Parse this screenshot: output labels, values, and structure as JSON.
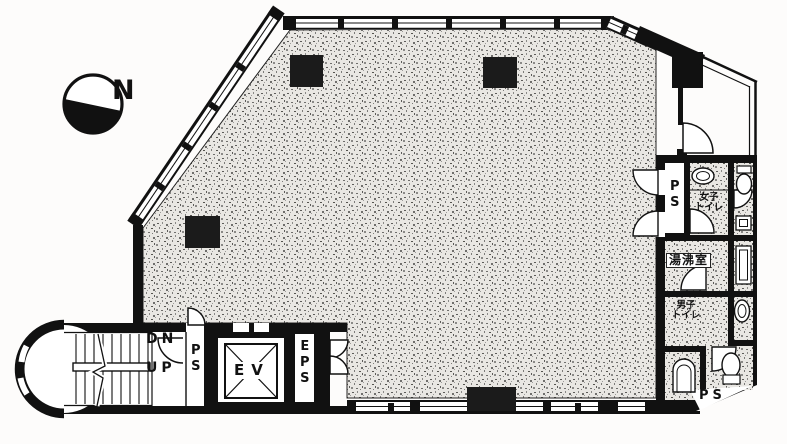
{
  "plan": {
    "compass": {
      "label": "N"
    },
    "stairwell": {
      "down_label": "DN",
      "up_label": "UP"
    },
    "shafts": {
      "stair_ps_label": "PS",
      "elevator_label": "EV",
      "eps_label": "EPS",
      "toilet_ps_top_label": "PS",
      "toilet_ps_bottom_label": "PS"
    },
    "rooms": {
      "womens_toilet_label": "女子\nトイレ",
      "kitchenette_label": "湯沸室",
      "mens_toilet_label": "男子\nトイレ"
    },
    "colors": {
      "wall": "#151515",
      "hatch_bg": "#e9e7e3",
      "hatch_dot": "#6f6e6c",
      "paper": "#fdfcfb"
    }
  }
}
